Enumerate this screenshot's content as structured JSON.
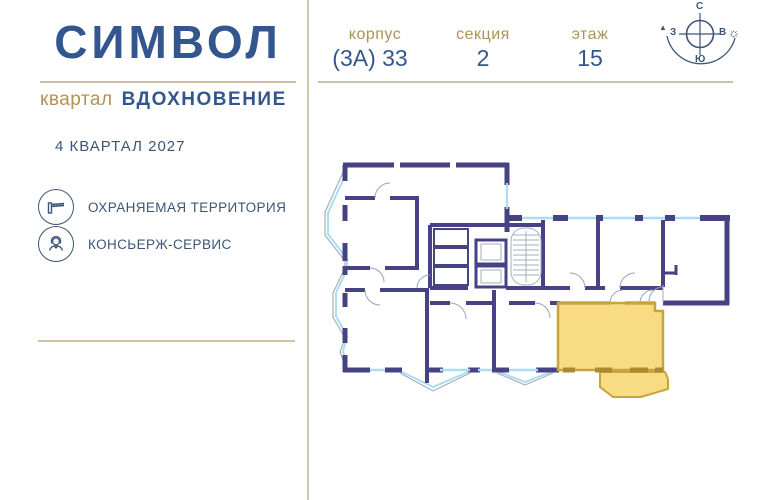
{
  "brand": {
    "logo": "СИМВОЛ",
    "subtitle_prefix": "квартал",
    "subtitle": "ВДОХНОВЕНИЕ",
    "completion": "4 КВАРТАЛ 2027",
    "features": [
      {
        "icon": "barrier-icon",
        "label": "ОХРАНЯЕМАЯ ТЕРРИТОРИЯ"
      },
      {
        "icon": "concierge-icon",
        "label": "КОНСЬЕРЖ-СЕРВИС"
      }
    ]
  },
  "meta": {
    "corpus": {
      "label": "корпус",
      "value": "(3А) 33"
    },
    "section": {
      "label": "секция",
      "value": "2"
    },
    "floor": {
      "label": "этаж",
      "value": "15"
    }
  },
  "compass": {
    "north": "С",
    "south": "Ю",
    "west": "З",
    "east": "В",
    "sun_icon": "☼",
    "west_marker": "▲"
  },
  "colors": {
    "brand_blue": "#33568e",
    "gold": "#b29254",
    "rule_tan": "#cdc3a4",
    "wall_indigo": "#474284",
    "window_blue": "#aadcf2",
    "outline_gray": "#a7aebb",
    "highlight_fill": "#f7da7d",
    "highlight_border": "#c8a43e"
  }
}
